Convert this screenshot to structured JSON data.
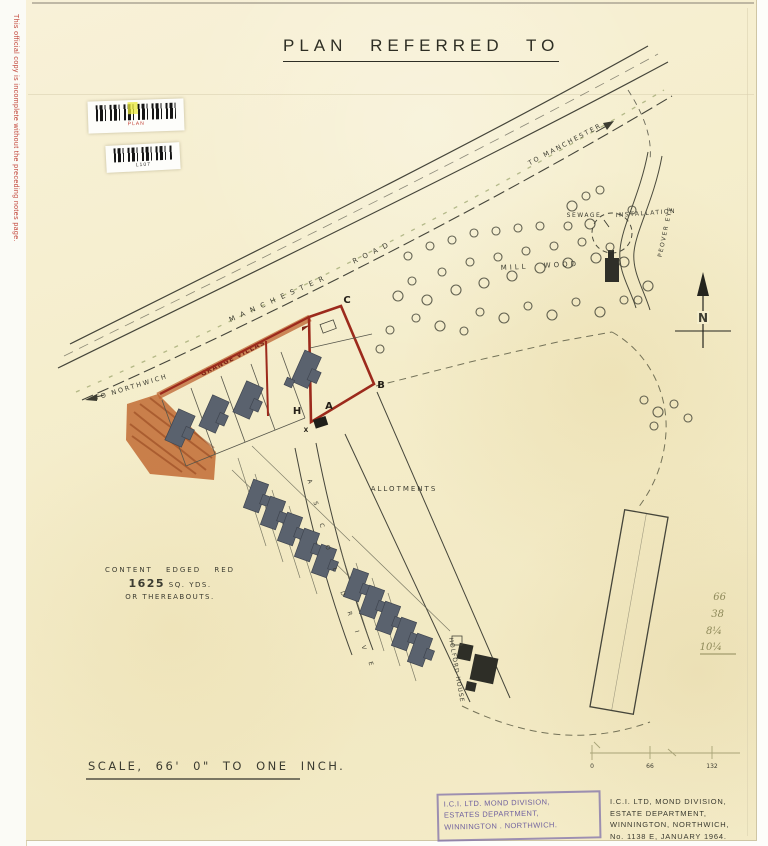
{
  "sheet": {
    "title": "PLAN REFERRED TO",
    "margin_note": "This official copy is incomplete without the preceding notes page.",
    "barcode_1_label": "PLAN",
    "barcode_2_label": "L107"
  },
  "labels": {
    "to_manchester": "TO MANCHESTER",
    "manchester": "MANCHESTER",
    "road": "ROAD",
    "to_northwich": "TO NORTHWICH",
    "grange_villas": "GRANGE VILLAS",
    "mill_wood": "MILL WOOD",
    "sewage": "SEWAGE",
    "installation": "INSTALLATION",
    "peover_eye": "PEOVER EYE",
    "allotments": "ALLOTMENTS",
    "holford_house": "HOLFORD HOUSE",
    "north": "N",
    "ascol_letters": [
      "A",
      "S",
      "C",
      "O",
      "L",
      "D",
      "R",
      "I",
      "V",
      "E"
    ]
  },
  "plot": {
    "corner_c": "C",
    "corner_b": "B",
    "corner_a": "A",
    "corner_h": "H",
    "mark_x": "X"
  },
  "content_note": {
    "line1": "CONTENT EDGED RED",
    "area": "1625",
    "units": " SQ. YDS.",
    "line3": "OR THEREABOUTS."
  },
  "scale_note": "SCALE, 66' 0\" TO ONE INCH.",
  "scale_bar": {
    "t0": "0",
    "t1": "66",
    "t2": "132"
  },
  "stamp": {
    "line1": "I.C.I. LTD. MOND DIVISION,",
    "line2": "ESTATES DEPARTMENT,",
    "line3": "WINNINGTON . NORTHWICH."
  },
  "title_block": {
    "line1": "I.C.I. LTD, MOND DIVISION,",
    "line2": "ESTATE DEPARTMENT,",
    "line3": "WINNINGTON, NORTHWICH,",
    "line4": "No. 1138 E, JANUARY 1964."
  },
  "margin_figures": {
    "f1": "66",
    "f2": "38",
    "f3": "8¼",
    "f4": "10¼"
  },
  "colors": {
    "paper": "#f5eecd",
    "plot_red": "#9c2a1c",
    "verge_orange": "#c0662e",
    "stamp_purple": "#8172ab",
    "ink": "#3c3c31",
    "pencil": "#97925f",
    "house": "#5a626e"
  }
}
